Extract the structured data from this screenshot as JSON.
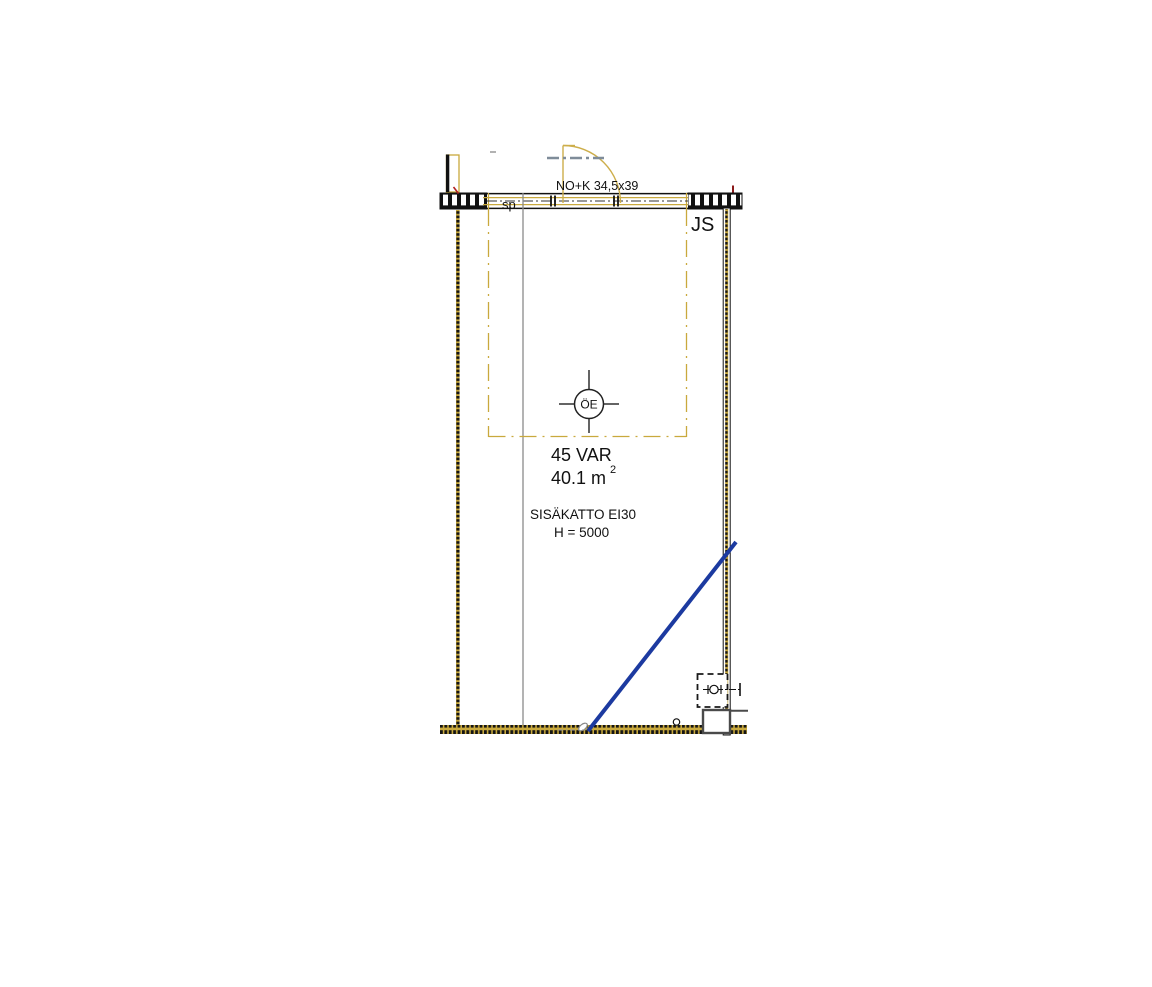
{
  "plan": {
    "room_number_label": "45 VAR",
    "room_area": "40.1 m",
    "room_area_sup": "2",
    "ceiling_label": "SISÄKATTO EI30",
    "height_label": "H = 5000",
    "door_label": "NO+K 34,5x39",
    "beam_label": "JS",
    "sprinkler_label": "sp",
    "symbol_label": "ÖE",
    "colors": {
      "accent_gold": "#C9A93D",
      "pipe_blue": "#1C3AA0",
      "text_blue": "#3E6BC8"
    }
  }
}
